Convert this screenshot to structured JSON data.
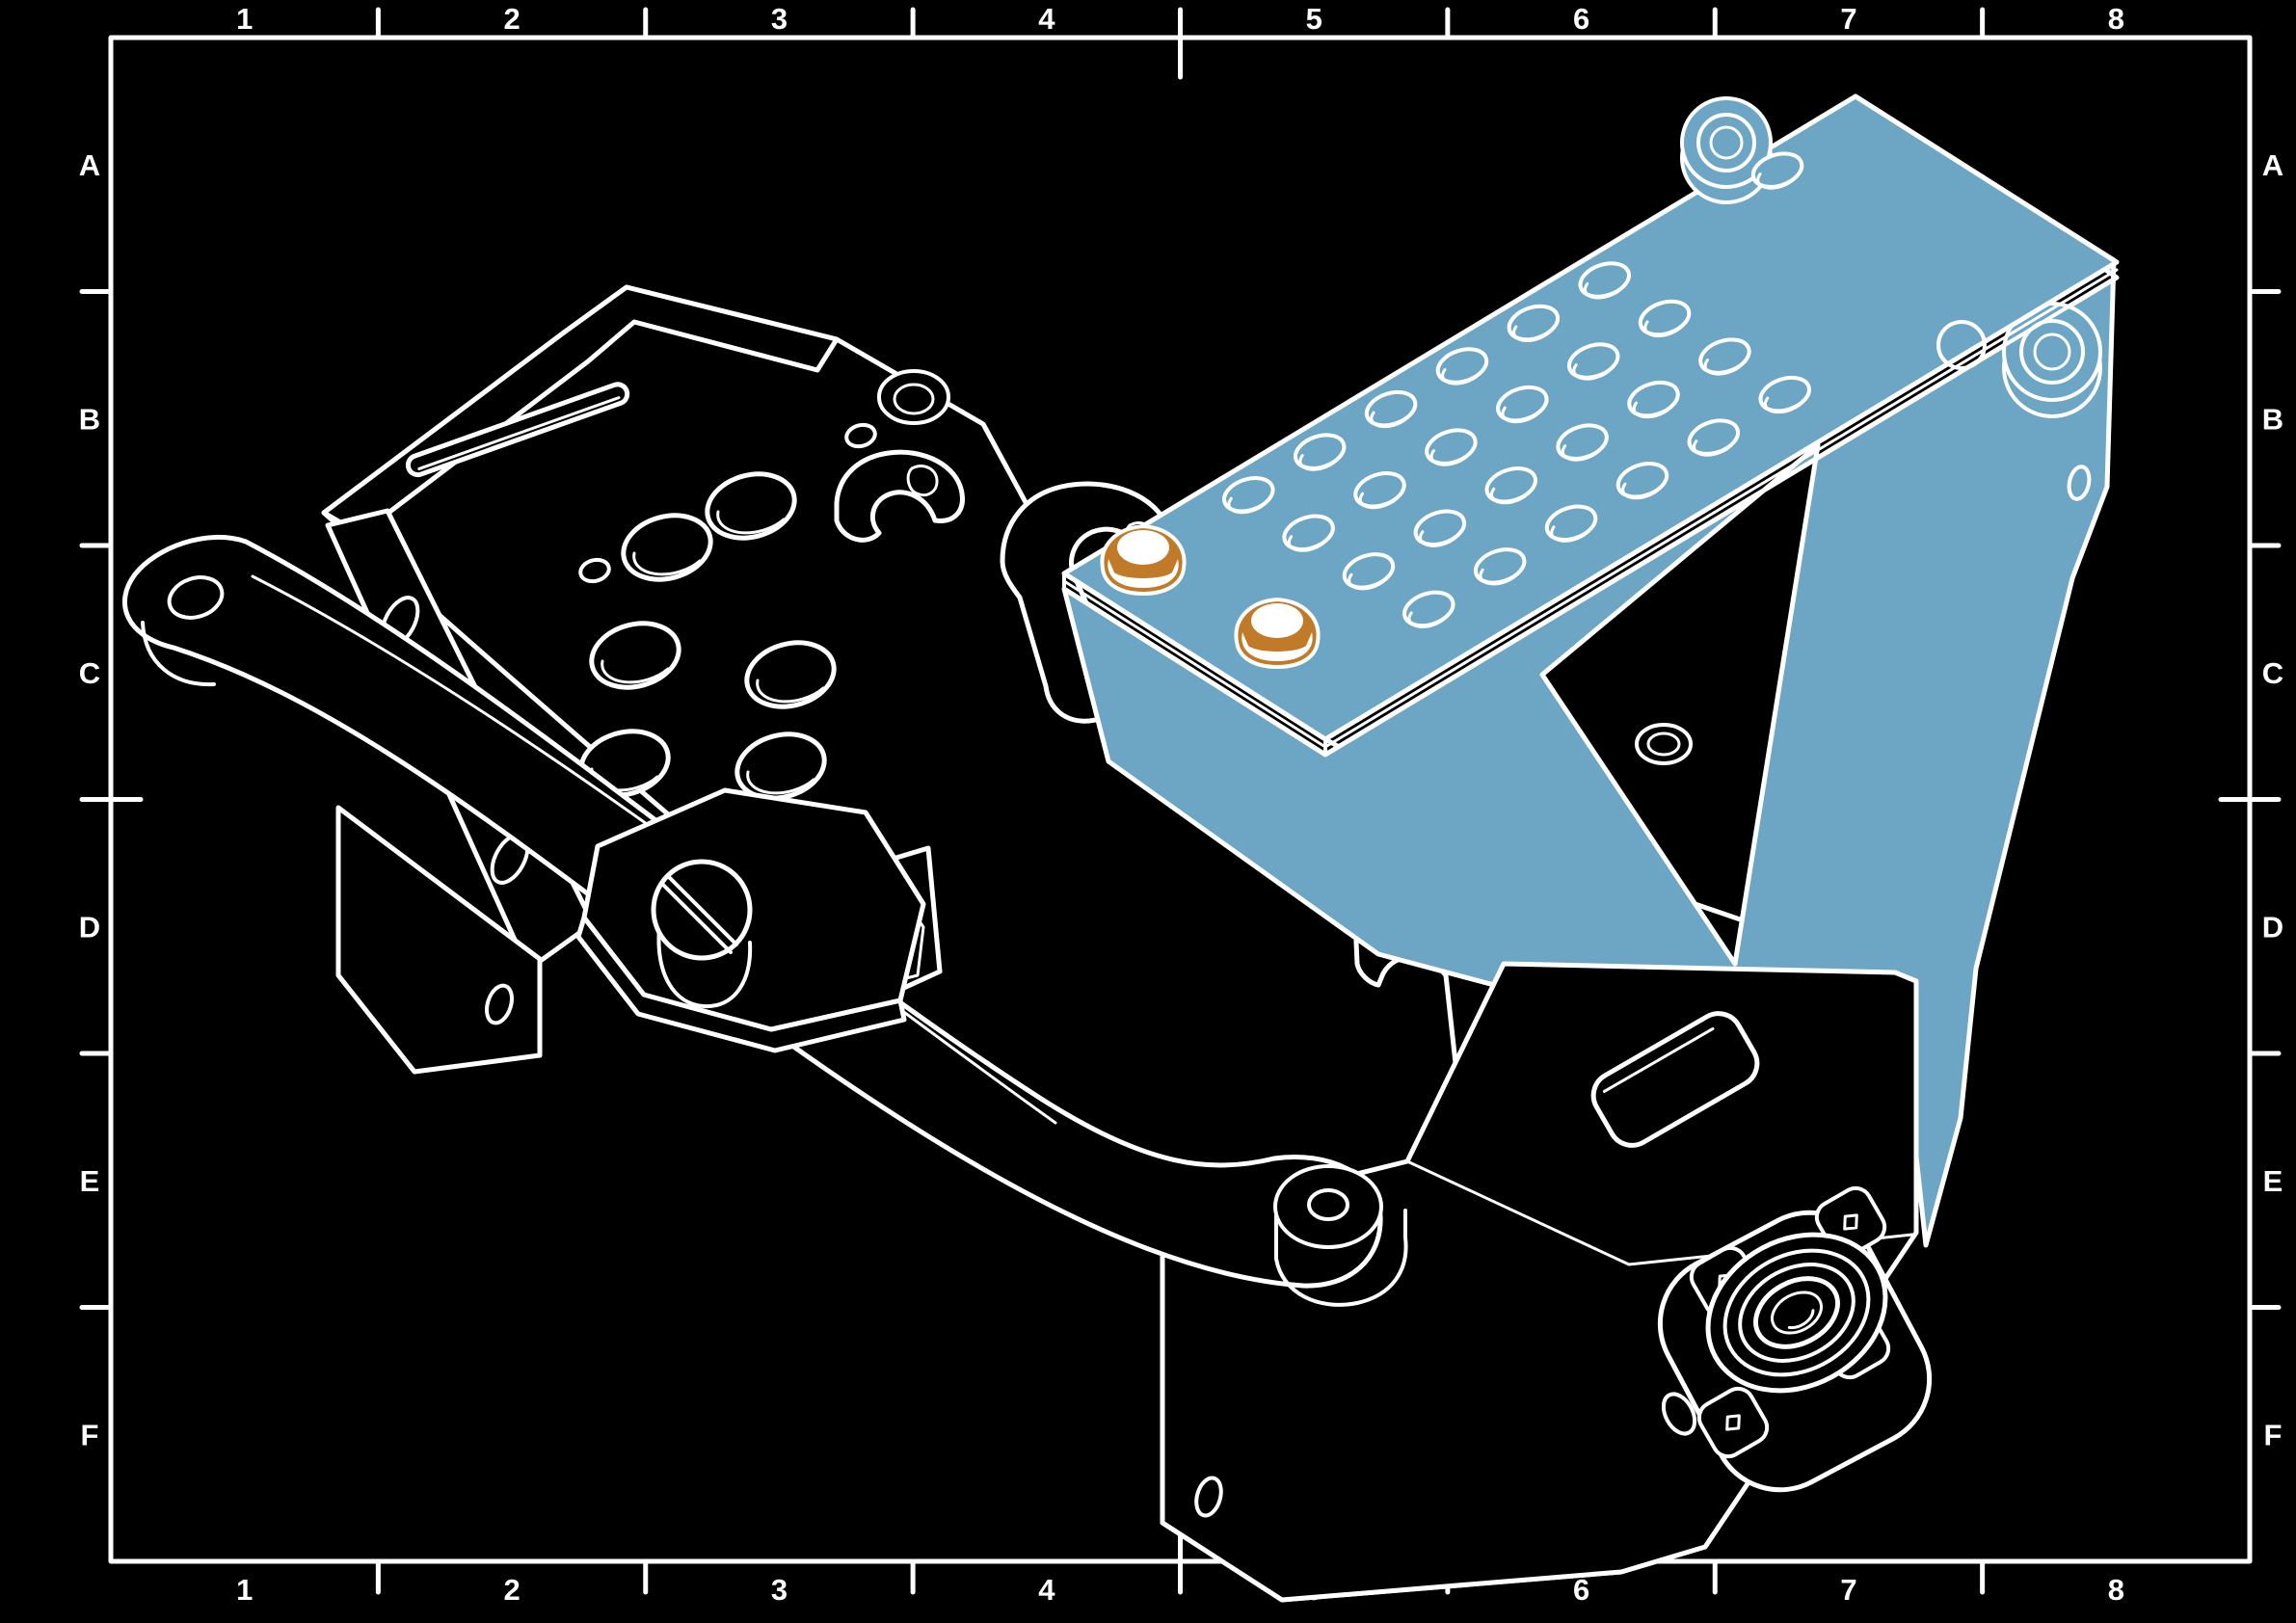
{
  "drawing": {
    "type": "isometric-assembly-drawing",
    "colors": {
      "background": "#000000",
      "line": "#ffffff",
      "highlight_part": "#6CA6C4",
      "fastener": "#C07A28"
    },
    "border": {
      "column_labels": [
        "1",
        "2",
        "3",
        "4",
        "5",
        "6",
        "7",
        "8"
      ],
      "row_labels": [
        "A",
        "B",
        "C",
        "D",
        "E",
        "F"
      ]
    }
  }
}
